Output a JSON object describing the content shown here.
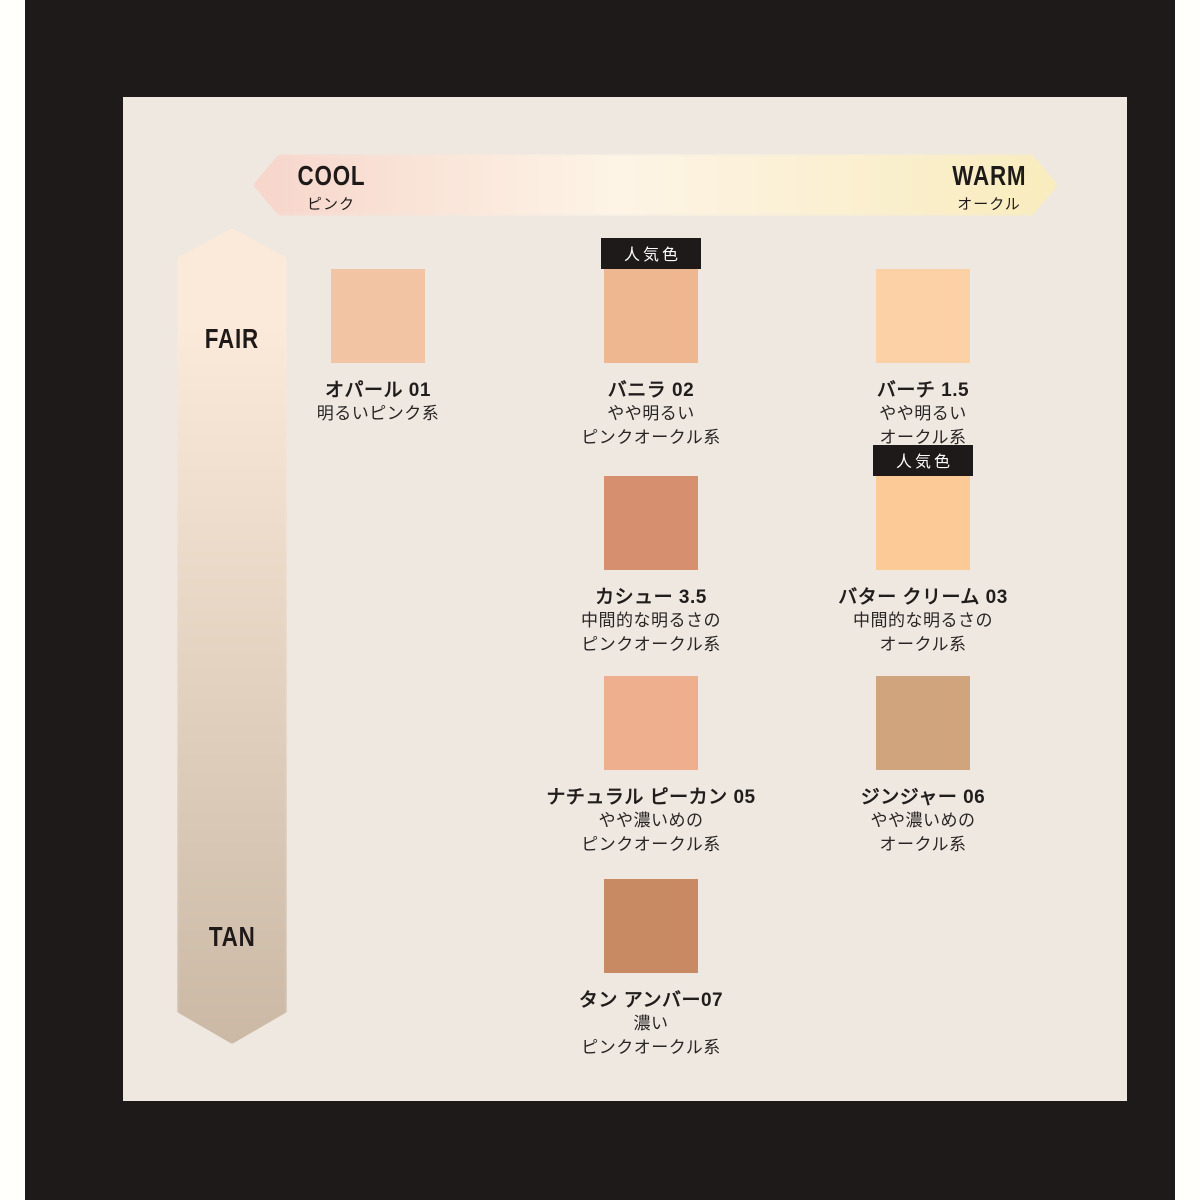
{
  "page": {
    "outer_bg": "#fffffb",
    "frame_bg": "#1d1a19",
    "panel_bg": "#eee8e1"
  },
  "temperature_axis": {
    "cool": {
      "label": "COOL",
      "sublabel": "ピンク"
    },
    "warm": {
      "label": "WARM",
      "sublabel": "オークル"
    },
    "gradient_left": "#f7d5cb",
    "gradient_mid": "#fdf4e6",
    "gradient_right": "#f9ecbd"
  },
  "depth_axis": {
    "fair_label": "FAIR",
    "tan_label": "TAN",
    "gradient_top": "#fbeada",
    "gradient_bottom": "#cbb9a6"
  },
  "badge_label": "人気色",
  "shades": [
    {
      "name": "オパール 01",
      "desc1": "明るいピンク系",
      "desc2": "",
      "color": "#f2c4a4",
      "popular": false
    },
    {
      "name": "バニラ 02",
      "desc1": "やや明るい",
      "desc2": "ピンクオークル系",
      "color": "#efb78f",
      "popular": true
    },
    {
      "name": "バーチ 1.5",
      "desc1": "やや明るい",
      "desc2": "オークル系",
      "color": "#fbd1a5",
      "popular": false
    },
    {
      "name": "カシュー 3.5",
      "desc1": "中間的な明るさの",
      "desc2": "ピンクオークル系",
      "color": "#d69070",
      "popular": false
    },
    {
      "name": "バター クリーム 03",
      "desc1": "中間的な明るさの",
      "desc2": "オークル系",
      "color": "#fbca96",
      "popular": true
    },
    {
      "name": "ナチュラル ピーカン 05",
      "desc1": "やや濃いめの",
      "desc2": "ピンクオークル系",
      "color": "#edaf8e",
      "popular": false
    },
    {
      "name": "ジンジャー 06",
      "desc1": "やや濃いめの",
      "desc2": "オークル系",
      "color": "#d0a47d",
      "popular": false
    },
    {
      "name": "タン アンバー07",
      "desc1": "濃い",
      "desc2": "ピンクオークル系",
      "color": "#c88a62",
      "popular": false
    }
  ]
}
